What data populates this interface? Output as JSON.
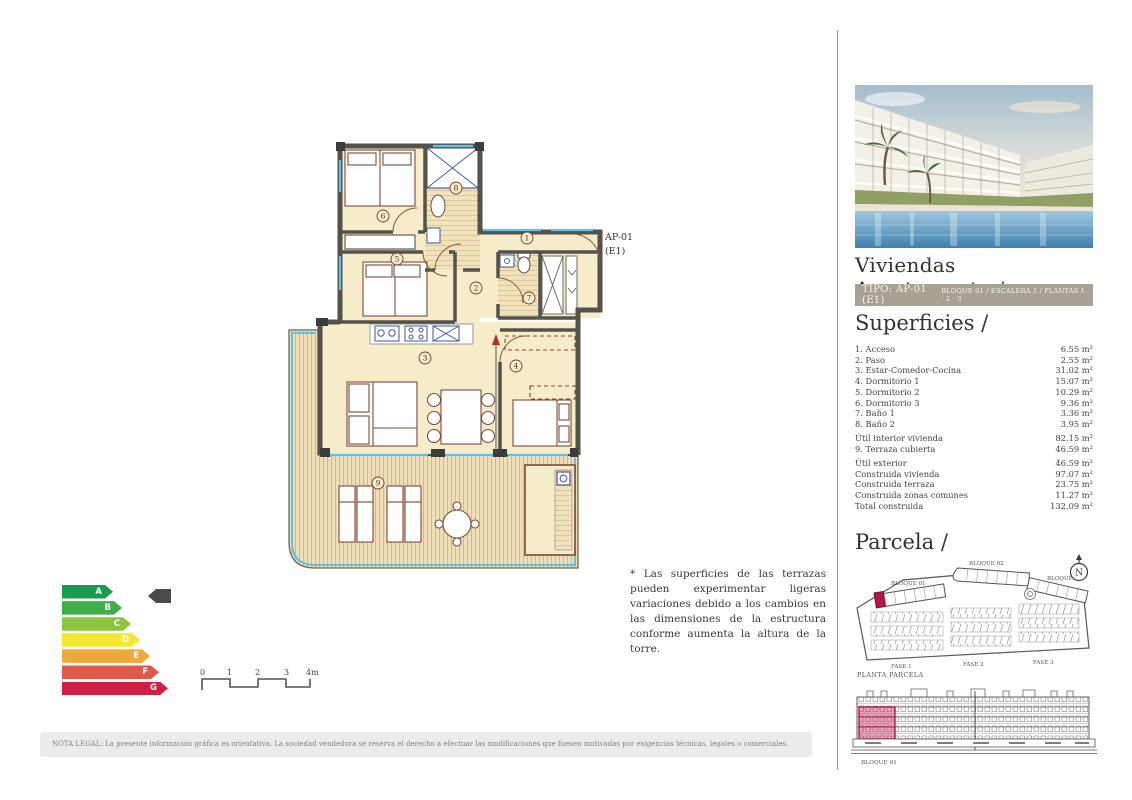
{
  "plan": {
    "unit_label": "AP-01",
    "unit_sublabel": "(E1)",
    "rooms": [
      "1",
      "2",
      "3",
      "4",
      "5",
      "6",
      "7",
      "8",
      "9"
    ]
  },
  "energy_label": {
    "ratings": [
      {
        "letter": "A",
        "color": "#1a9b4d"
      },
      {
        "letter": "B",
        "color": "#3fae49"
      },
      {
        "letter": "C",
        "color": "#8cc63f"
      },
      {
        "letter": "D",
        "color": "#f2e831"
      },
      {
        "letter": "E",
        "color": "#f0a73c"
      },
      {
        "letter": "F",
        "color": "#dd5a4b"
      },
      {
        "letter": "G",
        "color": "#d12045"
      }
    ],
    "indicator_color": "#4a4b4d"
  },
  "scale_bar": {
    "ticks": [
      "0",
      "1",
      "2",
      "3",
      "4m"
    ]
  },
  "disclaimer": "* Las superficies de las terrazas pueden experimentar ligeras variaciones debido a los cambios en las dimensiones de la estructura conforme aumenta la altura de la torre.",
  "legal_note": "NOTA LEGAL: La presente información gráfica es orientativa. La sociedad vendedora se reserva el derecho a efectuar las modificaciones que fuesen motivadas por exigencias técnicas, legales o comerciales.",
  "sidebar": {
    "title": "Viviendas Apartamento /",
    "type_bar": {
      "type": "TIPO: AP-01 (E1)",
      "location": "BLOQUE 01  / ESCALERA 1 / PLANTAS 1 · 2 · 3"
    },
    "surfaces": {
      "heading": "Superficies /",
      "rows": [
        {
          "label": "1. Acceso",
          "value": "6.55 m²"
        },
        {
          "label": "2. Paso",
          "value": "2.55 m²"
        },
        {
          "label": "3. Estar-Comedor-Cocina",
          "value": "31.02 m²"
        },
        {
          "label": "4. Dormitorio 1",
          "value": "15.07 m²"
        },
        {
          "label": "5. Dormitorio 2",
          "value": "10.29 m²"
        },
        {
          "label": "6. Dormitorio 3",
          "value": "9.36 m²"
        },
        {
          "label": "7. Baño 1",
          "value": "3.36 m²"
        },
        {
          "label": "8. Baño 2",
          "value": "3.95 m²"
        },
        {
          "label": "Útil interior vivienda",
          "value": "82.15 m²"
        },
        {
          "label": "9. Terraza cubierta",
          "value": "46.59 m²"
        },
        {
          "label": "Útil exterior",
          "value": "46.59 m²"
        },
        {
          "label": "Construida vivienda",
          "value": "97.07 m²"
        },
        {
          "label": "Construida terraza",
          "value": "23.75 m²"
        },
        {
          "label": "Construida zonas comunes",
          "value": "11.27 m²"
        },
        {
          "label": "Total construida",
          "value": "132.09 m²"
        }
      ]
    },
    "parcela": {
      "heading": "Parcela /",
      "blocks": [
        "BLOQUE 01",
        "BLOQUE 02",
        "BLOQUE 03"
      ],
      "phases": [
        "FASE 1",
        "FASE 2",
        "FASE 3"
      ],
      "caption": "PLANTA PARCELA",
      "compass": "N"
    },
    "elevation": {
      "label": "BLOQUE 01"
    }
  },
  "colors": {
    "type_bar_bg": "#a8a294",
    "highlight_red": "#b5174a",
    "glazing_blue": "#5bc3e4",
    "wall_gray": "#55524c",
    "room_cream": "#f6ecca",
    "deck_tan": "#eeddb6"
  }
}
